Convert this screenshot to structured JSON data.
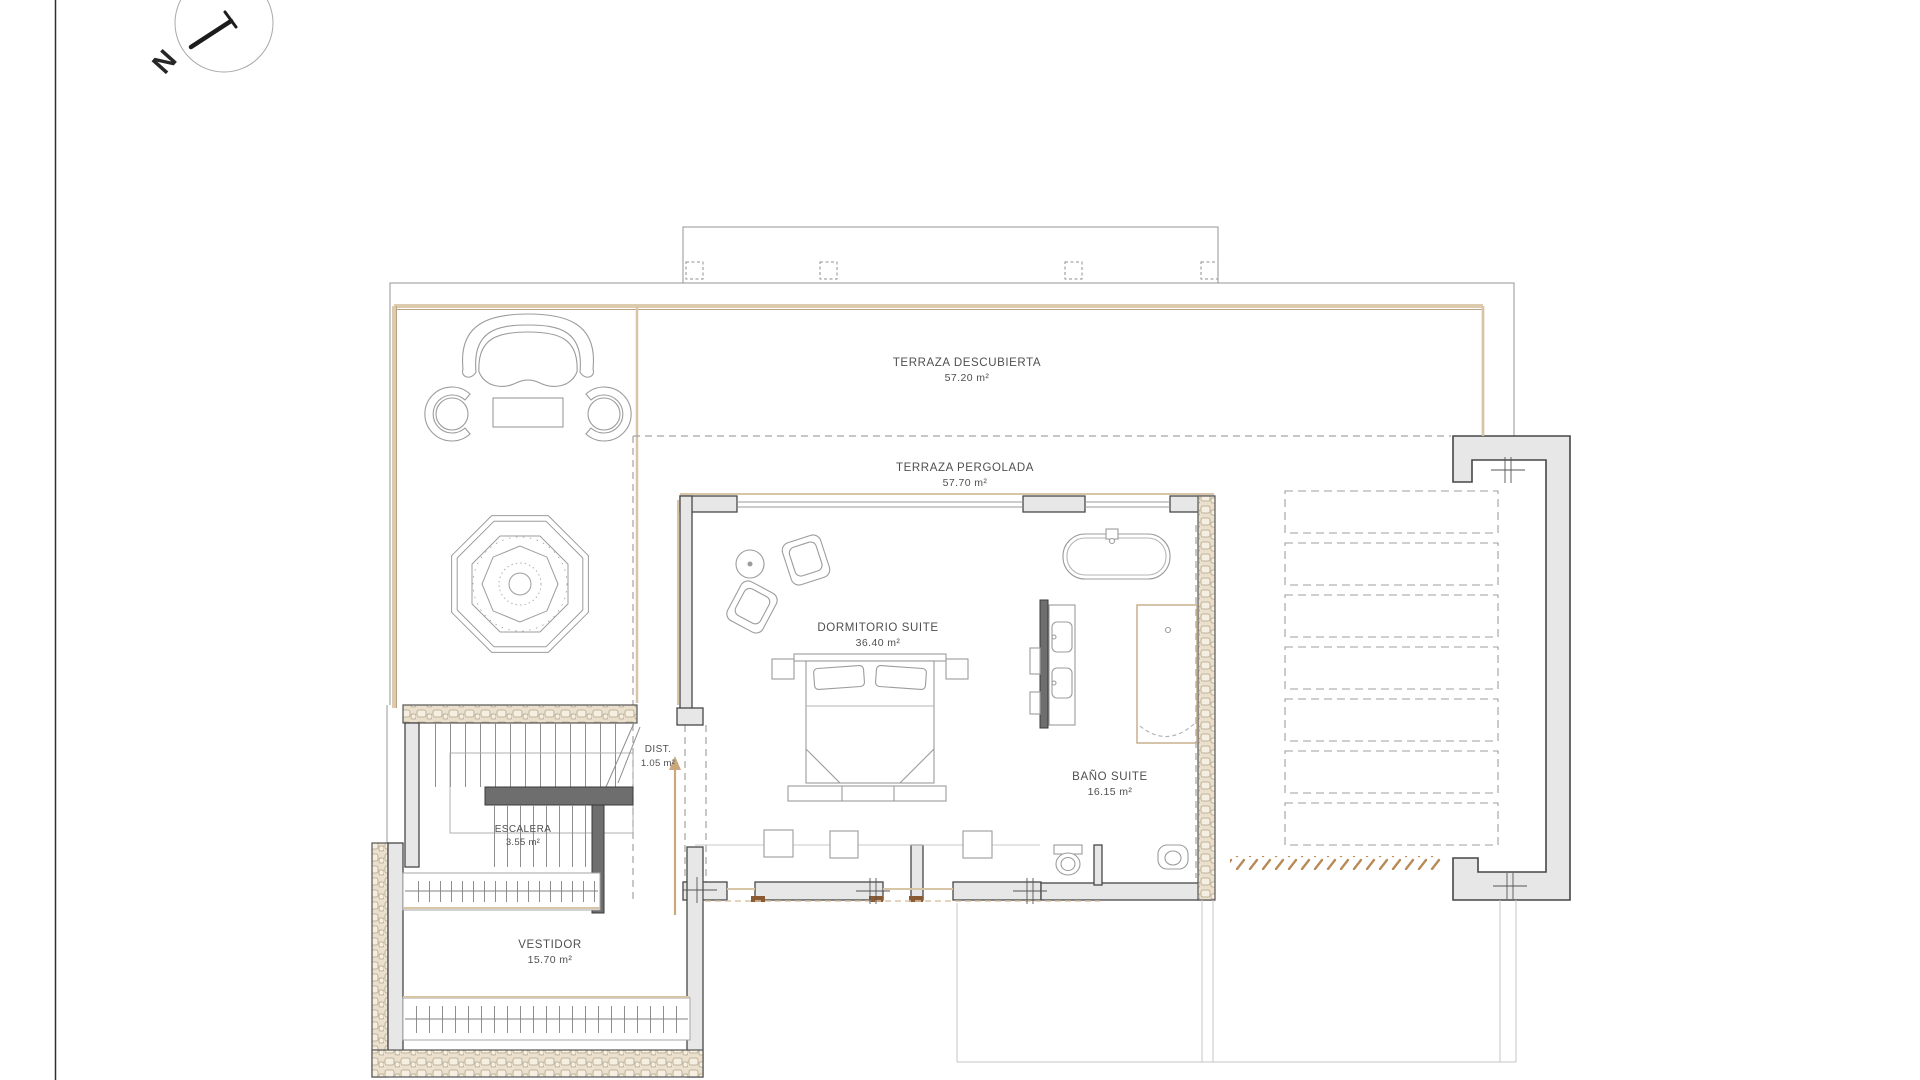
{
  "compass": {
    "label": "N"
  },
  "rooms": [
    {
      "name": "TERRAZA DESCUBIERTA",
      "area": "57.20 m²"
    },
    {
      "name": "TERRAZA PERGOLADA",
      "area": "57.70 m²"
    },
    {
      "name": "DORMITORIO SUITE",
      "area": "36.40 m²"
    },
    {
      "name": "BAÑO SUITE",
      "area": "16.15 m²"
    },
    {
      "name": "DIST.",
      "area": "1.05 m²"
    },
    {
      "name": "ESCALERA",
      "area": "3.55 m²"
    },
    {
      "name": "VESTIDOR",
      "area": "15.70 m²"
    }
  ],
  "colors": {
    "wall_fill": "#e7e7e7",
    "wall_stroke": "#474747",
    "dark_wall": "#6e6e6e",
    "tan": "#d8c5a7",
    "tan_dark": "#b9a384",
    "wood_marker": "#8a5a33",
    "hatch_tan": "#b98a55",
    "thin_line": "#9c9c9c"
  }
}
